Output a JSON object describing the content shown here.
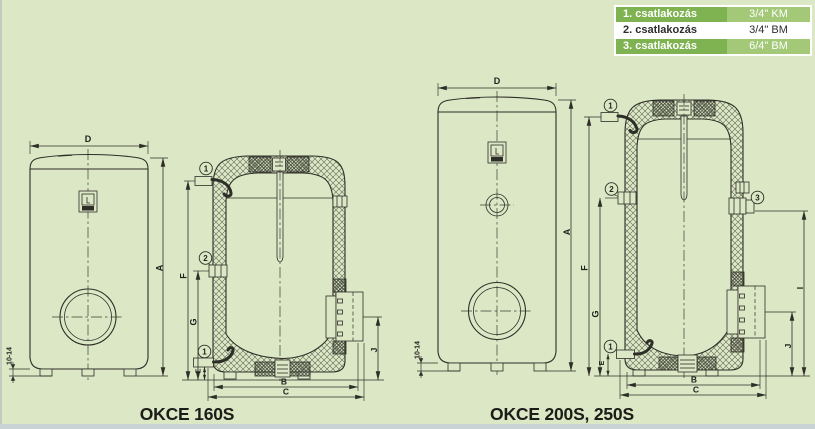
{
  "colors": {
    "background": "#dbe7c5",
    "line": "#2e2e28",
    "table_label_green": "#7fb251",
    "table_value_green": "#a2c878",
    "table_text_light": "#ffffff",
    "table_text_dark": "#2f2e2c",
    "bottom_edge": "#c9d3d6"
  },
  "table": {
    "rows": [
      {
        "label": "1. csatlakozás",
        "value": "3/4\" KM",
        "highlight": true
      },
      {
        "label": "2. csatlakozás",
        "value": "3/4\" BM",
        "highlight": false
      },
      {
        "label": "3. csatlakozás",
        "value": "6/4\" BM",
        "highlight": true
      }
    ]
  },
  "diagram_left": {
    "title": "OKCE 160S",
    "front_view": {
      "width": "D",
      "height": "A",
      "feet_height": "10-14"
    },
    "section_view": {
      "top_connection": "F",
      "mid_connection": "G",
      "bottom_connection": "E",
      "inner_width": "B",
      "outer_width": "C",
      "box_height": "J",
      "callout_top": "1",
      "callout_mid": "2",
      "callout_bottom": "1"
    }
  },
  "diagram_right": {
    "title": "OKCE 200S, 250S",
    "front_view": {
      "width": "D",
      "height": "A",
      "feet_height": "10-14"
    },
    "section_view": {
      "top_connection": "F",
      "mid_connection": "G",
      "bottom_connection": "E",
      "side_connection": "I",
      "inner_width": "B",
      "outer_width": "C",
      "box_height": "J",
      "callout_top": "1",
      "callout_mid": "2",
      "callout_side": "3",
      "callout_bottom": "1"
    }
  }
}
